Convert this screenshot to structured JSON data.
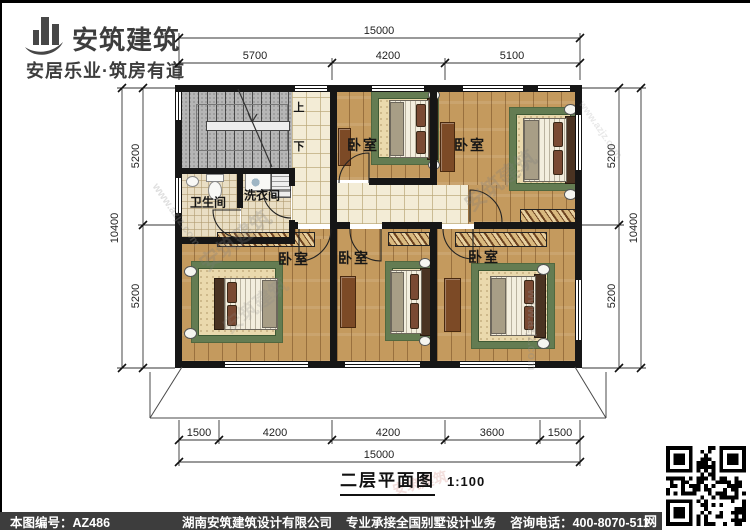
{
  "logo": {
    "name": "安筑建筑",
    "tagline": "安居乐业·筑房有道"
  },
  "rooms": {
    "bedroom": "卧室",
    "bathroom": "卫生间",
    "laundry": "洗衣间",
    "stair_up": "上",
    "stair_down": "下"
  },
  "dimensions": {
    "top": {
      "overall": "15000",
      "segments": [
        "5700",
        "4200",
        "5100"
      ]
    },
    "bottom": {
      "overall": "15000",
      "segments": [
        "1500",
        "4200",
        "4200",
        "3600",
        "1500"
      ]
    },
    "left": {
      "overall": "10400",
      "segments": [
        "5200",
        "5200"
      ]
    },
    "right": {
      "overall": "10400",
      "segments": [
        "5200",
        "5200"
      ]
    }
  },
  "title": {
    "text": "二层平面图",
    "scale": "1:100"
  },
  "footer": {
    "drawing_no": "本图编号：AZ486",
    "company": "湖南安筑建筑设计有限公司",
    "service": "专业承接全国别墅设计业务",
    "phone": "咨询电话：400-8070-511",
    "qr_label": "网"
  },
  "watermarks": {
    "brand": "安筑建筑",
    "site": "www.azjz.com"
  }
}
